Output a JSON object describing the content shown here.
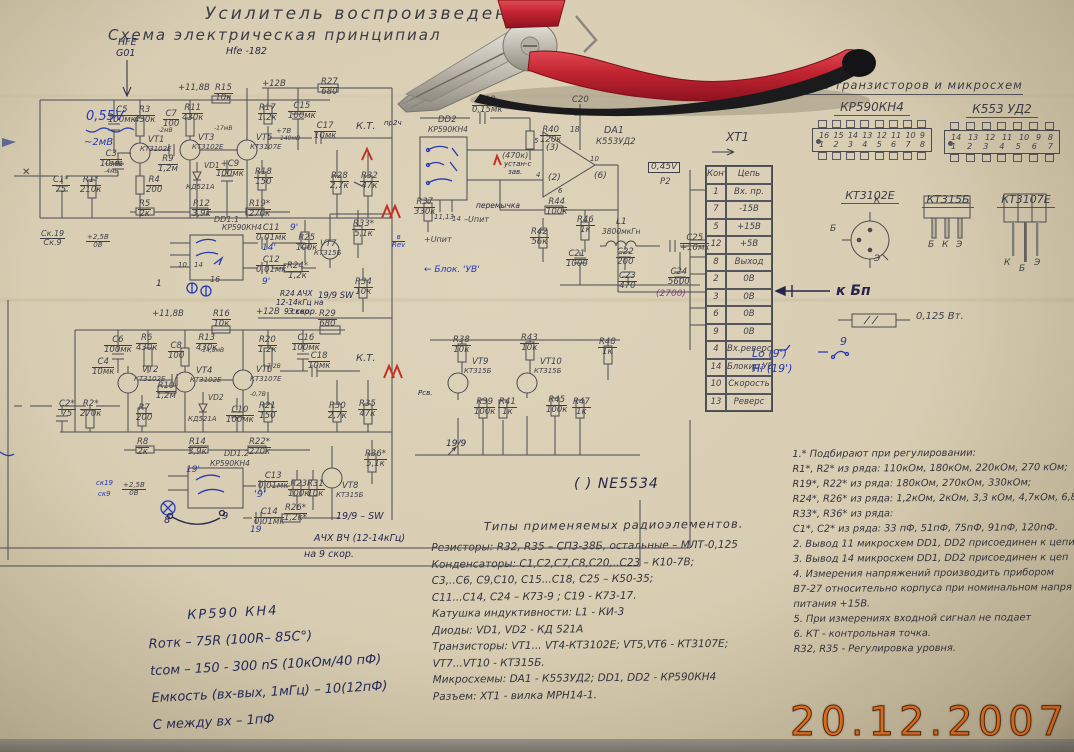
{
  "photo": {
    "date_stamp": "20.12.2007",
    "paper_color": "#d8cdb2",
    "stamp_color": "#f2731d"
  },
  "title": {
    "line1": "Усилитель  воспроизведения",
    "line2": "Схема  электрическая  принципиал",
    "pen_note1": "НFE G01",
    "pen_note2": "Hfe -182"
  },
  "pinout_panel": {
    "heading": "вка  транзисторов  и  микросхем",
    "chips": [
      {
        "name": "КР590КН4",
        "top_pins": [
          "16",
          "15",
          "14",
          "13",
          "12",
          "11",
          "10",
          "9"
        ],
        "bottom_pins": [
          "1",
          "2",
          "3",
          "4",
          "5",
          "6",
          "7",
          "8"
        ]
      },
      {
        "name": "К553 УД2",
        "top_pins": [
          "14",
          "13",
          "12",
          "11",
          "10",
          "9",
          "8"
        ],
        "bottom_pins": [
          "1",
          "2",
          "3",
          "4",
          "5",
          "6",
          "7"
        ]
      }
    ],
    "transistors": [
      {
        "name": "КТ3102Е",
        "pins": [
          "К",
          "Б",
          "Э"
        ]
      },
      {
        "name": "КТ315Б",
        "pins": [
          "Б",
          "К",
          "Э"
        ]
      },
      {
        "name": "КТ3107Е",
        "pins": [
          "К",
          "Б",
          "Э"
        ]
      }
    ],
    "to_psu": "к Бп",
    "resistor_note": "0,125 Вт."
  },
  "connector": {
    "title": "ХТ1",
    "col1": "Конт.",
    "col2": "Цепь",
    "rows": [
      [
        "1",
        "Вх. пр."
      ],
      [
        "7",
        "-15В"
      ],
      [
        "5",
        "+15В"
      ],
      [
        "12",
        "+5В"
      ],
      [
        "8",
        "Выход"
      ],
      [
        "2",
        "0В"
      ],
      [
        "3",
        "0В"
      ],
      [
        "6",
        "0В"
      ],
      [
        "9",
        "0В"
      ],
      [
        "4",
        "Вх.реверс"
      ],
      [
        "14",
        "Блокир.УВ"
      ],
      [
        "10",
        "Скорость"
      ],
      [
        "13",
        "Реверс"
      ]
    ],
    "annotation_lo": "Lo (9')",
    "annotation_hi": "Hi (19')",
    "annotation_sw": "9"
  },
  "parts_list": {
    "title": "Типы  применяемых  радиоэлементов.",
    "lines": [
      "Резисторы:  R32, R35 – СП3-38Б,  остальные – МЛТ-0,125",
      "Конденсаторы: С1,С2,С7,С8,С20,..С23 – К10-7В;",
      "С3,..С6, С9,С10, С15...С18, С25  –  К50-35;",
      "С11...С14, С24 –  К73-9 ;  С19 - К73-17.",
      "Катушка индуктивности: L1 - КИ-3",
      "Диоды:  VD1, VD2 - КД 521А",
      "Транзисторы:  VT1... VT4-КТ3102Е; VT5,VT6 - КТ3107Е;",
      "VT7...VT10  -  КТ315Б.",
      "Микросхемы:  DA1 - К553УД2;  DD1, DD2 - КР590КН4",
      "Разъем: ХТ1 - вилка МРН14-1."
    ]
  },
  "notes": {
    "lines": [
      "1.* Подбирают при регулировании:",
      "R1*, R2*  из ряда:  110кОм, 180кОм, 220кОм,  270 кОм;",
      "R19*, R22*  из ряда:  180кОм,  270кОм,  330кОм;",
      "R24*, R26*  из ряда:  1,2кОм,  2кОм, 3,3 кОм,  4,7кОм, 6,8кО",
      "R33*, R36* из ряда:",
      "С1*, С2*  из ряда:  33 пФ, 51пФ,  75пФ,  91пФ,  120пФ.",
      "2. Вывод 11 микросхем DD1, DD2 присоединен к цепи",
      "3. Вывод 14 микросхем DD1, DD2  присоединен к цеп",
      "4. Измерения напряжений  производить  прибором",
      "В7-27 относительно корпуса при номинальном напря",
      "питания +15В.",
      "5.  При измерениях  входной  сигнал  не подает",
      "6.  КТ -  контрольная  точка.",
      "R32, R35 - Регулировка  уровня."
    ]
  },
  "handwritten_specs": {
    "lines": [
      "КР590 КН4",
      "Rотк  –  75R (100R– 85C°)",
      "tсом  –  150 - 300 nS  (10кОм/40 пФ)",
      "Емкость (вх-вых, 1мГц)  –  10(12пФ)",
      "С между вх  –  1пФ"
    ]
  },
  "ne5534_note": "( ) NE5534",
  "schematic": {
    "labels": [
      {
        "t": "+11,8В",
        "x": 178,
        "y": 84
      },
      {
        "t": "С5|100мк",
        "x": 108,
        "y": 106
      },
      {
        "t": "R3|430к",
        "x": 134,
        "y": 106
      },
      {
        "t": "С7|100",
        "x": 163,
        "y": 110
      },
      {
        "t": "R11|430к",
        "x": 182,
        "y": 104
      },
      {
        "t": "R15|10к",
        "x": 214,
        "y": 84
      },
      {
        "t": "+12В",
        "x": 262,
        "y": 80
      },
      {
        "t": "R27|680",
        "x": 320,
        "y": 78
      },
      {
        "t": "R17|1,2к",
        "x": 258,
        "y": 104
      },
      {
        "t": "С15|100мк",
        "x": 288,
        "y": 102
      },
      {
        "t": "С17|10мк",
        "x": 314,
        "y": 122
      },
      {
        "t": "К.Т.",
        "x": 356,
        "y": 122,
        "s": 10
      },
      {
        "t": "VT1",
        "x": 148,
        "y": 136
      },
      {
        "t": "КТ3102Е",
        "x": 140,
        "y": 146,
        "s": 7
      },
      {
        "t": "VT3",
        "x": 198,
        "y": 134
      },
      {
        "t": "КТ3102Е",
        "x": 192,
        "y": 144,
        "s": 7
      },
      {
        "t": "VT5",
        "x": 256,
        "y": 134
      },
      {
        "t": "КТ3107Е",
        "x": 250,
        "y": 144,
        "s": 7
      },
      {
        "t": "С3|10мк",
        "x": 100,
        "y": 150
      },
      {
        "t": "С1*|75",
        "x": 52,
        "y": 176
      },
      {
        "t": "R1*|210к",
        "x": 80,
        "y": 176
      },
      {
        "t": "R4|200",
        "x": 146,
        "y": 176
      },
      {
        "t": "R9|1,2м",
        "x": 158,
        "y": 155
      },
      {
        "t": "VD1",
        "x": 204,
        "y": 162,
        "s": 7.5
      },
      {
        "t": "КД521А",
        "x": 186,
        "y": 184,
        "s": 7
      },
      {
        "t": "+С9|100мк",
        "x": 216,
        "y": 160
      },
      {
        "t": "R18|150",
        "x": 254,
        "y": 168
      },
      {
        "t": "R28|2,7к",
        "x": 330,
        "y": 172
      },
      {
        "t": "R32|47к",
        "x": 360,
        "y": 172
      },
      {
        "t": "+7В",
        "x": 276,
        "y": 128,
        "s": 7
      },
      {
        "t": "140мВ",
        "x": 280,
        "y": 136,
        "s": 6
      },
      {
        "t": "-2мВ",
        "x": 158,
        "y": 128,
        "s": 6
      },
      {
        "t": "-17мВ",
        "x": 214,
        "y": 126,
        "s": 6
      },
      {
        "t": "+8,5В",
        "x": 104,
        "y": 162,
        "s": 6
      },
      {
        "t": "-4мВ",
        "x": 104,
        "y": 169,
        "s": 6
      },
      {
        "t": "R5|2к",
        "x": 138,
        "y": 200
      },
      {
        "t": "R12|3,9к",
        "x": 192,
        "y": 200
      },
      {
        "t": "DD1.1",
        "x": 214,
        "y": 216,
        "s": 8
      },
      {
        "t": "КР590КН4",
        "x": 222,
        "y": 224,
        "s": 7.5
      },
      {
        "t": "R19*|270к",
        "x": 248,
        "y": 200
      },
      {
        "t": "С11|0,01мк",
        "x": 256,
        "y": 224
      },
      {
        "t": "С12|0,01мк",
        "x": 256,
        "y": 256
      },
      {
        "t": "R24*|1,2к",
        "x": 286,
        "y": 262
      },
      {
        "t": "R25|100к",
        "x": 296,
        "y": 234
      },
      {
        "t": "VT7",
        "x": 320,
        "y": 240
      },
      {
        "t": "КТ315Б",
        "x": 314,
        "y": 250,
        "s": 7
      },
      {
        "t": "R33*|5,1к",
        "x": 352,
        "y": 220
      },
      {
        "t": "R34|10к",
        "x": 354,
        "y": 278
      },
      {
        "t": "10",
        "x": 178,
        "y": 262,
        "s": 7
      },
      {
        "t": "14",
        "x": 194,
        "y": 262,
        "s": 7
      },
      {
        "t": "16",
        "x": 210,
        "y": 276,
        "s": 8
      },
      {
        "t": "1",
        "x": 156,
        "y": 280,
        "c": "pen",
        "s": 9
      },
      {
        "t": "14'",
        "x": 262,
        "y": 244,
        "c": "blue",
        "s": 9
      },
      {
        "t": "9'",
        "x": 262,
        "y": 278,
        "c": "blue",
        "s": 9
      },
      {
        "t": "9'",
        "x": 290,
        "y": 224,
        "c": "blue",
        "s": 9
      },
      {
        "t": "R24 АЧХ",
        "x": 280,
        "y": 290,
        "c": "pen",
        "s": 7.5
      },
      {
        "t": "12-14кГц на",
        "x": 276,
        "y": 299,
        "c": "pen",
        "s": 7.5
      },
      {
        "t": "9 скор.",
        "x": 284,
        "y": 308,
        "c": "pen",
        "s": 7.5
      },
      {
        "t": "19/9 SW",
        "x": 318,
        "y": 292,
        "c": "pen",
        "s": 8.5
      },
      {
        "t": "С19|0,15мк",
        "x": 472,
        "y": 96
      },
      {
        "t": "DD2",
        "x": 438,
        "y": 116
      },
      {
        "t": "КР590КН4",
        "x": 428,
        "y": 126,
        "s": 7.5
      },
      {
        "t": "R40|120к",
        "x": 540,
        "y": 126
      },
      {
        "t": "(470к)",
        "x": 502,
        "y": 152,
        "s": 8
      },
      {
        "t": "устан-с",
        "x": 504,
        "y": 161,
        "c": "pen",
        "s": 7
      },
      {
        "t": "зав.",
        "x": 508,
        "y": 169,
        "c": "pen",
        "s": 7
      },
      {
        "t": "С20",
        "x": 572,
        "y": 96
      },
      {
        "t": "18",
        "x": 570,
        "y": 126,
        "s": 7.5
      },
      {
        "t": "DA1",
        "x": 604,
        "y": 126,
        "s": 9.5
      },
      {
        "t": "К553УД2",
        "x": 596,
        "y": 138,
        "s": 8.5
      },
      {
        "t": "(3)",
        "x": 546,
        "y": 144,
        "s": 9
      },
      {
        "t": "(2)",
        "x": 548,
        "y": 174,
        "s": 9
      },
      {
        "t": "(6)",
        "x": 594,
        "y": 172,
        "s": 9
      },
      {
        "t": "10",
        "x": 590,
        "y": 156,
        "s": 7
      },
      {
        "t": "5",
        "x": 534,
        "y": 138,
        "s": 7
      },
      {
        "t": "4",
        "x": 536,
        "y": 172,
        "s": 7
      },
      {
        "t": "6",
        "x": 558,
        "y": 188,
        "s": 7
      },
      {
        "t": "0,45V",
        "x": 648,
        "y": 162,
        "c": "inkbox",
        "s": 9
      },
      {
        "t": "Р2",
        "x": 660,
        "y": 178
      },
      {
        "t": "R44|100к",
        "x": 546,
        "y": 198
      },
      {
        "t": "R42|56к",
        "x": 530,
        "y": 228
      },
      {
        "t": "R46|1к",
        "x": 576,
        "y": 216
      },
      {
        "t": "L1",
        "x": 616,
        "y": 218,
        "s": 9
      },
      {
        "t": "3800мкГн",
        "x": 602,
        "y": 228,
        "s": 7.5
      },
      {
        "t": "С21|1000",
        "x": 566,
        "y": 250
      },
      {
        "t": "С22|200",
        "x": 616,
        "y": 248
      },
      {
        "t": "С23|470",
        "x": 618,
        "y": 272
      },
      {
        "t": "С25|+10мк",
        "x": 680,
        "y": 234
      },
      {
        "t": "С24|5600",
        "x": 668,
        "y": 268
      },
      {
        "t": "(2700)",
        "x": 656,
        "y": 290,
        "c": "purple",
        "s": 9
      },
      {
        "t": "R37|330к",
        "x": 414,
        "y": 198
      },
      {
        "t": "11,13",
        "x": 434,
        "y": 214,
        "s": 7
      },
      {
        "t": "14",
        "x": 452,
        "y": 216,
        "s": 7
      },
      {
        "t": "–Uпит",
        "x": 464,
        "y": 216,
        "s": 8
      },
      {
        "t": "+Uпит",
        "x": 424,
        "y": 236,
        "s": 8
      },
      {
        "t": "← Блок. 'УВ'",
        "x": 424,
        "y": 266,
        "c": "blue",
        "s": 9
      },
      {
        "t": "пр2ч",
        "x": 384,
        "y": 120,
        "c": "pen",
        "s": 7
      },
      {
        "t": "в|Rev",
        "x": 392,
        "y": 234,
        "c": "blue",
        "s": 7
      },
      {
        "t": "перемычка",
        "x": 476,
        "y": 202,
        "c": "pen",
        "s": 7.5
      },
      {
        "t": "+11,8В",
        "x": 152,
        "y": 310
      },
      {
        "t": "R16|10к",
        "x": 212,
        "y": 310
      },
      {
        "t": "+12В",
        "x": 256,
        "y": 308
      },
      {
        "t": "З скор.",
        "x": 288,
        "y": 308,
        "c": "pen",
        "s": 8
      },
      {
        "t": "R29|680",
        "x": 318,
        "y": 310
      },
      {
        "t": "С6|100мк",
        "x": 104,
        "y": 336
      },
      {
        "t": "R6|430к",
        "x": 136,
        "y": 334
      },
      {
        "t": "С8|100",
        "x": 168,
        "y": 342
      },
      {
        "t": "R13|430к",
        "x": 196,
        "y": 334
      },
      {
        "t": "R20|1,2к",
        "x": 258,
        "y": 336
      },
      {
        "t": "С16|100мк",
        "x": 292,
        "y": 334
      },
      {
        "t": "С18|10мк",
        "x": 308,
        "y": 352
      },
      {
        "t": "К.Т.",
        "x": 356,
        "y": 354,
        "s": 10
      },
      {
        "t": "VT2",
        "x": 142,
        "y": 366
      },
      {
        "t": "КТ3102Е",
        "x": 134,
        "y": 376,
        "s": 7
      },
      {
        "t": "VT4",
        "x": 196,
        "y": 367
      },
      {
        "t": "КТ3102Е",
        "x": 190,
        "y": 377,
        "s": 7
      },
      {
        "t": "VT6",
        "x": 256,
        "y": 366
      },
      {
        "t": "КТ3107Е",
        "x": 250,
        "y": 376,
        "s": 7
      },
      {
        "t": "С4|10мк",
        "x": 92,
        "y": 358
      },
      {
        "t": "С2*|75",
        "x": 58,
        "y": 400
      },
      {
        "t": "R2*|270к",
        "x": 80,
        "y": 400
      },
      {
        "t": "R7|200",
        "x": 136,
        "y": 404
      },
      {
        "t": "R10|1,2м",
        "x": 156,
        "y": 382
      },
      {
        "t": "VD2",
        "x": 208,
        "y": 394,
        "s": 7.5
      },
      {
        "t": "КД521А",
        "x": 188,
        "y": 416,
        "s": 7
      },
      {
        "t": "С10|100мк",
        "x": 226,
        "y": 406
      },
      {
        "t": "R21|150",
        "x": 258,
        "y": 402
      },
      {
        "t": "R30|2,7к",
        "x": 328,
        "y": 402
      },
      {
        "t": "R35|47к",
        "x": 358,
        "y": 400
      },
      {
        "t": "-14,8мВ",
        "x": 200,
        "y": 348,
        "s": 6
      },
      {
        "t": "+7,2В",
        "x": 262,
        "y": 364,
        "s": 6
      },
      {
        "t": "-0,7В",
        "x": 250,
        "y": 392,
        "s": 6
      },
      {
        "t": "R8|2к",
        "x": 136,
        "y": 438
      },
      {
        "t": "R14|3,9к",
        "x": 188,
        "y": 438
      },
      {
        "t": "DD1.2",
        "x": 224,
        "y": 450,
        "s": 8
      },
      {
        "t": "КР590КН4",
        "x": 210,
        "y": 460,
        "s": 7.5
      },
      {
        "t": "R22*|270к",
        "x": 248,
        "y": 438
      },
      {
        "t": "С13|0,01мк",
        "x": 258,
        "y": 472
      },
      {
        "t": "С14|0,01мк",
        "x": 254,
        "y": 508
      },
      {
        "t": "R26*|1,2к*",
        "x": 284,
        "y": 504
      },
      {
        "t": "R23|100к",
        "x": 288,
        "y": 480
      },
      {
        "t": "R31|10к",
        "x": 306,
        "y": 480
      },
      {
        "t": "VT8",
        "x": 342,
        "y": 482
      },
      {
        "t": "КТ315Б",
        "x": 336,
        "y": 492,
        "s": 7
      },
      {
        "t": "R36*|5,1к",
        "x": 364,
        "y": 450
      },
      {
        "t": "19/9 – SW",
        "x": 336,
        "y": 512,
        "c": "pen",
        "s": 9.5
      },
      {
        "t": "АЧХ ВЧ (12-14кГц)",
        "x": 314,
        "y": 534,
        "c": "pen",
        "s": 9.5
      },
      {
        "t": "на 9 скор.",
        "x": 304,
        "y": 550,
        "c": "pen",
        "s": 9.5
      },
      {
        "t": "19'",
        "x": 186,
        "y": 466,
        "c": "blue",
        "s": 9
      },
      {
        "t": "'9'",
        "x": 254,
        "y": 490,
        "c": "blue",
        "s": 10
      },
      {
        "t": "19",
        "x": 250,
        "y": 526,
        "c": "blue",
        "s": 9
      },
      {
        "t": "8",
        "x": 164,
        "y": 516,
        "c": "pen",
        "s": 10
      },
      {
        "t": "9",
        "x": 222,
        "y": 512,
        "c": "pen",
        "s": 10
      },
      {
        "t": "ск19",
        "x": 96,
        "y": 480,
        "c": "blue",
        "s": 7
      },
      {
        "t": "ск9",
        "x": 98,
        "y": 491,
        "c": "blue",
        "s": 7
      },
      {
        "t": "+2,5В|0В",
        "x": 122,
        "y": 482,
        "s": 7
      },
      {
        "t": "R38|10к",
        "x": 452,
        "y": 336
      },
      {
        "t": "R43|10к",
        "x": 520,
        "y": 334
      },
      {
        "t": "R48|1к",
        "x": 598,
        "y": 338
      },
      {
        "t": "VT9",
        "x": 472,
        "y": 358
      },
      {
        "t": "КТ315Б",
        "x": 464,
        "y": 368,
        "s": 7
      },
      {
        "t": "VT10",
        "x": 540,
        "y": 358
      },
      {
        "t": "КТ315Б",
        "x": 534,
        "y": 368,
        "s": 7
      },
      {
        "t": "R39|100к",
        "x": 474,
        "y": 398
      },
      {
        "t": "R41|1к",
        "x": 498,
        "y": 398
      },
      {
        "t": "R45|100к",
        "x": 546,
        "y": 396
      },
      {
        "t": "R47|1к",
        "x": 572,
        "y": 398
      },
      {
        "t": "Рсв.",
        "x": 418,
        "y": 390,
        "c": "pen",
        "s": 7
      },
      {
        "t": "19/9",
        "x": 446,
        "y": 440,
        "c": "pen",
        "s": 9
      },
      {
        "t": "Ск.19|Ск.9",
        "x": 40,
        "y": 230,
        "s": 8
      },
      {
        "t": "+2,5В|0В",
        "x": 86,
        "y": 234,
        "s": 7
      },
      {
        "t": "0,55V",
        "x": 86,
        "y": 110,
        "c": "blue",
        "s": 13
      },
      {
        "t": "~2мВ",
        "x": 84,
        "y": 138,
        "c": "blue",
        "s": 10
      },
      {
        "t": "✕",
        "x": 22,
        "y": 168,
        "s": 10
      },
      {
        "t": "НFE",
        "x": 118,
        "y": 38,
        "c": "pen",
        "s": 9.5
      },
      {
        "t": "G01",
        "x": 116,
        "y": 49,
        "c": "pen",
        "s": 9.5
      }
    ]
  }
}
